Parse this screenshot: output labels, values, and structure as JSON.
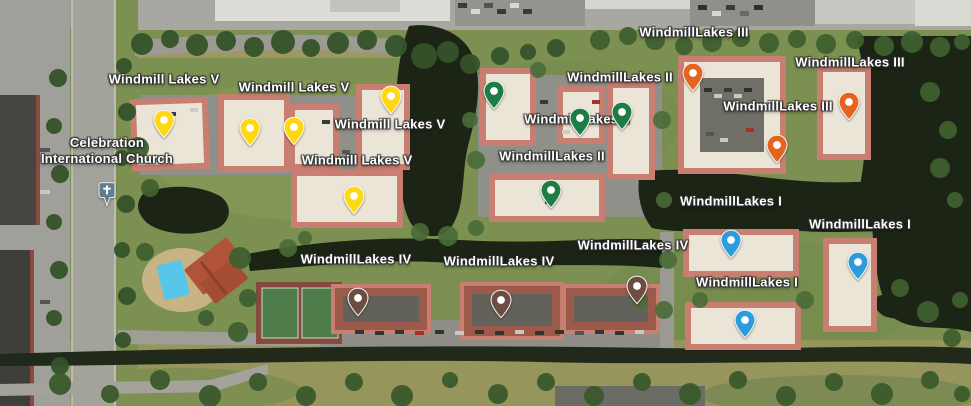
{
  "map": {
    "width": 971,
    "height": 406,
    "view_type": "satellite",
    "place_labels": [
      {
        "text": "Windmill Lakes V",
        "group": "Windmill Lakes V",
        "x": 164,
        "y": 79
      },
      {
        "text": "Windmill Lakes V",
        "group": "Windmill Lakes V",
        "x": 294,
        "y": 87
      },
      {
        "text": "Windmill Lakes V",
        "group": "Windmill Lakes V",
        "x": 390,
        "y": 124
      },
      {
        "text": "Windmill Lakes V",
        "group": "Windmill Lakes V",
        "x": 357,
        "y": 160
      },
      {
        "text": "WindmillLakes II",
        "group": "WindmillLakes II",
        "x": 620,
        "y": 77
      },
      {
        "text": "WindmillLakes II",
        "group": "WindmillLakes II",
        "x": 577,
        "y": 119
      },
      {
        "text": "WindmillLakes II",
        "group": "WindmillLakes II",
        "x": 552,
        "y": 156
      },
      {
        "text": "WindmillLakes III",
        "group": "WindmillLakes III",
        "x": 694,
        "y": 32
      },
      {
        "text": "WindmillLakes III",
        "group": "WindmillLakes III",
        "x": 850,
        "y": 62
      },
      {
        "text": "WindmillLakes III",
        "group": "WindmillLakes III",
        "x": 778,
        "y": 106
      },
      {
        "text": "WindmillLakes IV",
        "group": "WindmillLakes IV",
        "x": 356,
        "y": 259
      },
      {
        "text": "WindmillLakes IV",
        "group": "WindmillLakes IV",
        "x": 499,
        "y": 261
      },
      {
        "text": "WindmillLakes IV",
        "group": "WindmillLakes IV",
        "x": 633,
        "y": 245
      },
      {
        "text": "WindmillLakes I",
        "group": "WindmillLakes I",
        "x": 731,
        "y": 201
      },
      {
        "text": "WindmillLakes I",
        "group": "WindmillLakes I",
        "x": 860,
        "y": 224
      },
      {
        "text": "WindmillLakes I",
        "group": "WindmillLakes I",
        "x": 747,
        "y": 282
      }
    ],
    "pins": [
      {
        "group": "Windmill Lakes V",
        "color": "#FFD814",
        "x": 164,
        "y": 120
      },
      {
        "group": "Windmill Lakes V",
        "color": "#FFD814",
        "x": 250,
        "y": 128
      },
      {
        "group": "Windmill Lakes V",
        "color": "#FFD814",
        "x": 294,
        "y": 127
      },
      {
        "group": "Windmill Lakes V",
        "color": "#FFD814",
        "x": 391,
        "y": 96
      },
      {
        "group": "Windmill Lakes V",
        "color": "#FFD814",
        "x": 354,
        "y": 196
      },
      {
        "group": "WindmillLakes II",
        "color": "#1E7D45",
        "x": 494,
        "y": 91
      },
      {
        "group": "WindmillLakes II",
        "color": "#1E7D45",
        "x": 580,
        "y": 118
      },
      {
        "group": "WindmillLakes II",
        "color": "#1E7D45",
        "x": 622,
        "y": 112
      },
      {
        "group": "WindmillLakes II",
        "color": "#1E7D45",
        "x": 551,
        "y": 190
      },
      {
        "group": "WindmillLakes III",
        "color": "#E5631E",
        "x": 693,
        "y": 73
      },
      {
        "group": "WindmillLakes III",
        "color": "#E5631E",
        "x": 849,
        "y": 102
      },
      {
        "group": "WindmillLakes III",
        "color": "#E5631E",
        "x": 777,
        "y": 145
      },
      {
        "group": "WindmillLakes IV",
        "color": "#6D4C41",
        "x": 358,
        "y": 298
      },
      {
        "group": "WindmillLakes IV",
        "color": "#6D4C41",
        "x": 501,
        "y": 300
      },
      {
        "group": "WindmillLakes IV",
        "color": "#6D4C41",
        "x": 637,
        "y": 286
      },
      {
        "group": "WindmillLakes I",
        "color": "#2D9CDB",
        "x": 731,
        "y": 240
      },
      {
        "group": "WindmillLakes I",
        "color": "#2D9CDB",
        "x": 858,
        "y": 262
      },
      {
        "group": "WindmillLakes I",
        "color": "#2D9CDB",
        "x": 745,
        "y": 320
      }
    ],
    "church": {
      "line1": "Celebration",
      "line2": "International Church",
      "label_x": 107,
      "label_y": 151,
      "pin_x": 107,
      "pin_y": 190,
      "pin_color": "#5F7F8E",
      "icon": "cross-icon"
    }
  }
}
